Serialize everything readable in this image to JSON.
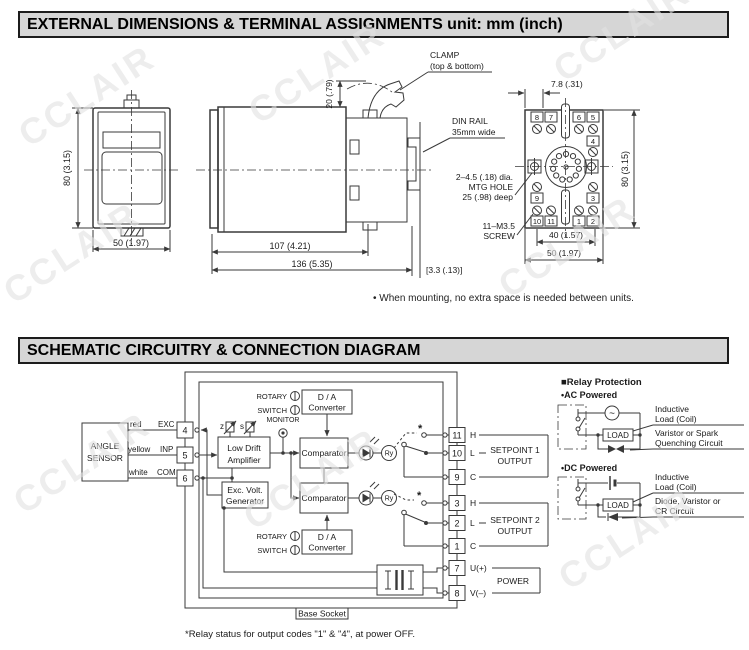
{
  "watermark": "CCLAIR",
  "section1": {
    "title": "EXTERNAL DIMENSIONS & TERMINAL ASSIGNMENTS unit: mm (inch)"
  },
  "dims": {
    "front": {
      "height": "80 (3.15)",
      "width": "50 (1.97)"
    },
    "side": {
      "clamp_line1": "CLAMP",
      "clamp_line2": "(top & bottom)",
      "din_line1": "DIN RAIL",
      "din_line2": "35mm wide",
      "clamp_height": "20 (.79)",
      "body_depth": "107 (4.21)",
      "total_depth": "136 (5.35)",
      "rail_offset": "[3.3 (.13)]"
    },
    "socket": {
      "pitch": "7.8 (.31)",
      "height": "80 (3.15)",
      "width_inner": "40 (1.57)",
      "width_outer": "50 (1.97)",
      "mtg_line1": "2–4.5 (.18) dia.",
      "mtg_line2": "MTG HOLE",
      "mtg_line3": "25 (.98) deep",
      "screw_line1": "11–M3.5",
      "screw_line2": "SCREW",
      "top_terminals": [
        "8",
        "7",
        "6",
        "5"
      ],
      "right_upper": "4",
      "left_mid": "9",
      "right_mid": "3",
      "bottom_terminals": [
        "10",
        "11",
        "1",
        "2"
      ]
    },
    "note": "• When mounting, no extra space is needed between units."
  },
  "section2": {
    "title": "SCHEMATIC CIRCUITRY & CONNECTION DIAGRAM"
  },
  "schematic": {
    "sensor": {
      "line1": "ANGLE",
      "line2": "SENSOR",
      "wires": [
        {
          "color": "red",
          "signal": "EXC",
          "terminal": "4"
        },
        {
          "color": "yellow",
          "signal": "INP",
          "terminal": "5"
        },
        {
          "color": "white",
          "signal": "COM",
          "terminal": "6"
        }
      ]
    },
    "blocks": {
      "rotary_line1": "ROTARY",
      "rotary_line2": "SWITCH",
      "da_line1": "D / A",
      "da_line2": "Converter",
      "monitor": "MONITOR",
      "zero": "z",
      "span": "s",
      "amp_line1": "Low Drift",
      "amp_line2": "Amplifier",
      "gen_line1": "Exc. Volt.",
      "gen_line2": "Generator",
      "comparator": "Comparator",
      "relay": "Ry",
      "asterisk": "*",
      "base_socket": "Base Socket"
    },
    "right_terminals": [
      {
        "num": "11",
        "label": "H"
      },
      {
        "num": "10",
        "label": "L"
      },
      {
        "num": "9",
        "label": "C"
      },
      {
        "num": "3",
        "label": "H"
      },
      {
        "num": "2",
        "label": "L"
      },
      {
        "num": "1",
        "label": "C"
      },
      {
        "num": "7",
        "label": "U(+)"
      },
      {
        "num": "8",
        "label": "V(–)"
      }
    ],
    "outputs": {
      "sp1_line1": "SETPOINT 1",
      "sp1_line2": "OUTPUT",
      "sp2_line1": "SETPOINT 2",
      "sp2_line2": "OUTPUT",
      "power": "POWER"
    },
    "footnote": "*Relay status for output codes \"1\" & \"4\", at power OFF."
  },
  "relay_protection": {
    "title": "■Relay Protection",
    "ac_title": "•AC Powered",
    "dc_title": "•DC Powered",
    "load": "LOAD",
    "ac_source": "~",
    "ac_label1_line1": "Inductive",
    "ac_label1_line2": "Load (Coil)",
    "ac_label2_line1": "Varistor or Spark",
    "ac_label2_line2": "Quenching Circuit",
    "dc_label1_line1": "Inductive",
    "dc_label1_line2": "Load (Coil)",
    "dc_label2_line1": "Diode, Varistor or",
    "dc_label2_line2": "CR Circuit"
  }
}
